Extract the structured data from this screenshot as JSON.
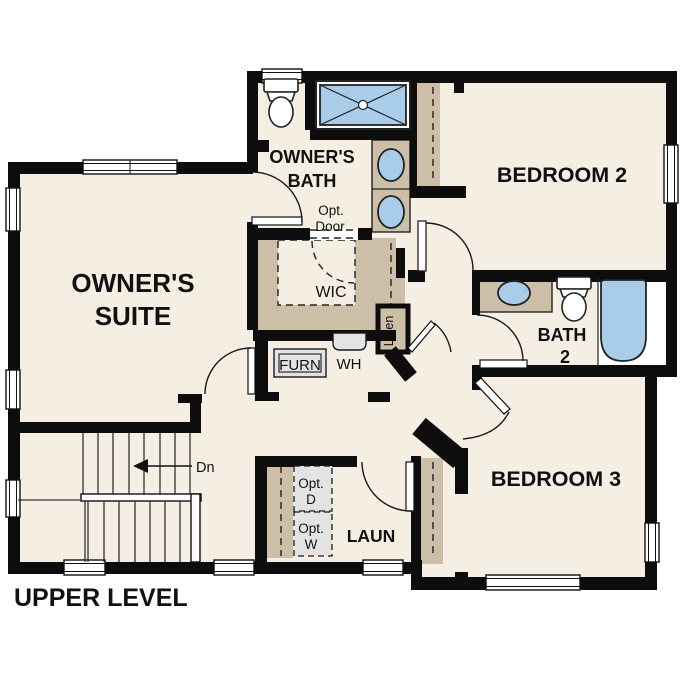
{
  "title": "UPPER LEVEL",
  "colors": {
    "floor": "#f5eee2",
    "cabinet_tan": "#cdbfa7",
    "fixture_blue": "#a9cce8",
    "wall_black": "#0d0d0d",
    "appliance_grey": "#e3e3e3"
  },
  "rooms": {
    "owners_suite": {
      "line1": "OWNER'S",
      "line2": "SUITE"
    },
    "owners_bath": {
      "line1": "OWNER'S",
      "line2": "BATH"
    },
    "bedroom2": {
      "label": "BEDROOM 2"
    },
    "bedroom3": {
      "label": "BEDROOM 3"
    },
    "bath2": {
      "line1": "BATH",
      "line2": "2"
    },
    "laundry": {
      "label": "LAUN"
    },
    "wic": {
      "label": "WIC"
    },
    "linen": {
      "label": "Linen"
    }
  },
  "annotations": {
    "opt_door": {
      "line1": "Opt.",
      "line2": "Door"
    },
    "opt_dryer": {
      "line1": "Opt.",
      "line2": "D"
    },
    "opt_washer": {
      "line1": "Opt.",
      "line2": "W"
    },
    "furnace": {
      "label": "FURN"
    },
    "water_heater": {
      "label": "WH"
    },
    "stairs_down": {
      "label": "Dn"
    }
  }
}
